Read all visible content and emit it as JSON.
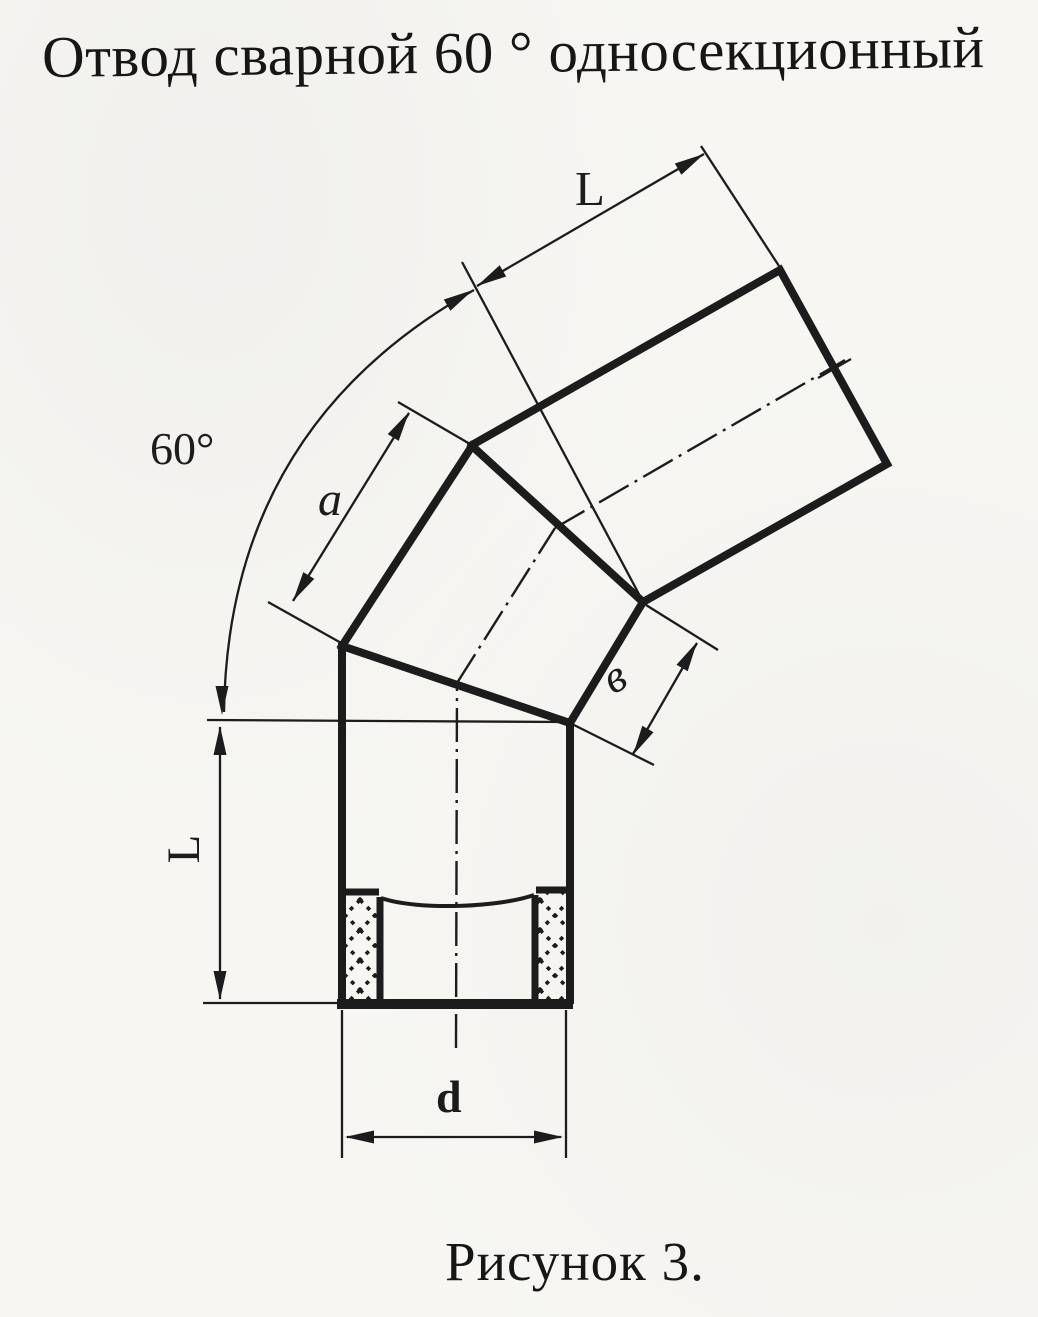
{
  "page": {
    "background": "#f7f6f3",
    "ink": "#1c1c1c"
  },
  "title": "Отвод сварной 60 ° односекционный",
  "caption": "Рисунок 3.",
  "labels": {
    "angle": "60°",
    "upper_length": "L",
    "lower_length": "L",
    "middle_long_side": "a",
    "middle_short_side": "в",
    "diameter": "d"
  }
}
